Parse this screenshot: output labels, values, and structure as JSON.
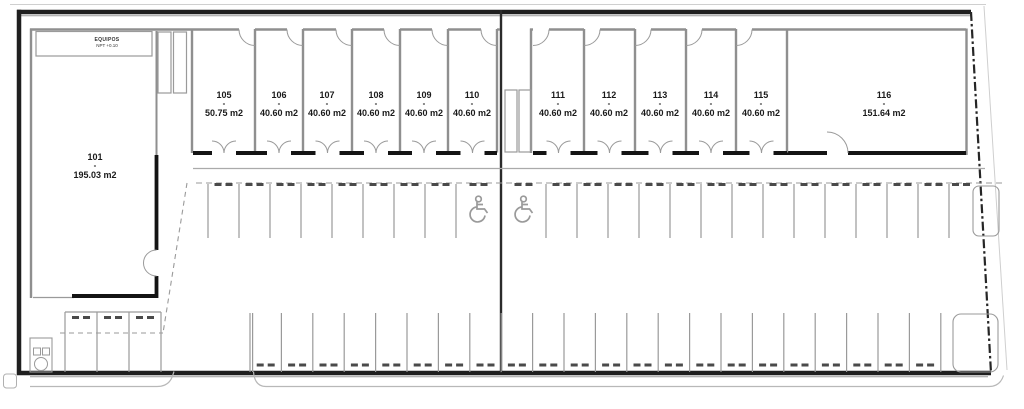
{
  "plan_title": "ground-floor site plan",
  "label_separator": "-",
  "equipment_room": {
    "name": "EQUIPOS",
    "level": "NPT +0.10"
  },
  "units": [
    {
      "id": "101",
      "area": "195.03 m2"
    },
    {
      "id": "105",
      "area": "50.75 m2"
    },
    {
      "id": "106",
      "area": "40.60 m2"
    },
    {
      "id": "107",
      "area": "40.60 m2"
    },
    {
      "id": "108",
      "area": "40.60 m2"
    },
    {
      "id": "109",
      "area": "40.60 m2"
    },
    {
      "id": "110",
      "area": "40.60 m2"
    },
    {
      "id": "111",
      "area": "40.60 m2"
    },
    {
      "id": "112",
      "area": "40.60 m2"
    },
    {
      "id": "113",
      "area": "40.60 m2"
    },
    {
      "id": "114",
      "area": "40.60 m2"
    },
    {
      "id": "115",
      "area": "40.60 m2"
    },
    {
      "id": "116",
      "area": "151.64 m2"
    }
  ],
  "parking": {
    "upper_row": {
      "regular_spaces_left": 8,
      "accessible_spaces": 2,
      "regular_spaces_right": 14
    },
    "lower_row": {
      "spaces": 22
    },
    "lower_left_row": {
      "spaces": 3
    }
  },
  "colors": {
    "wall_heavy": "#141414",
    "wall_light": "#8f8f8f",
    "boundary": "#1f1f1f",
    "parking_line": "#9a9a9a",
    "wheel_stop": "#4a4a4a",
    "accessible_icon": "#9a9a9a",
    "text": "#1a1a1a"
  }
}
